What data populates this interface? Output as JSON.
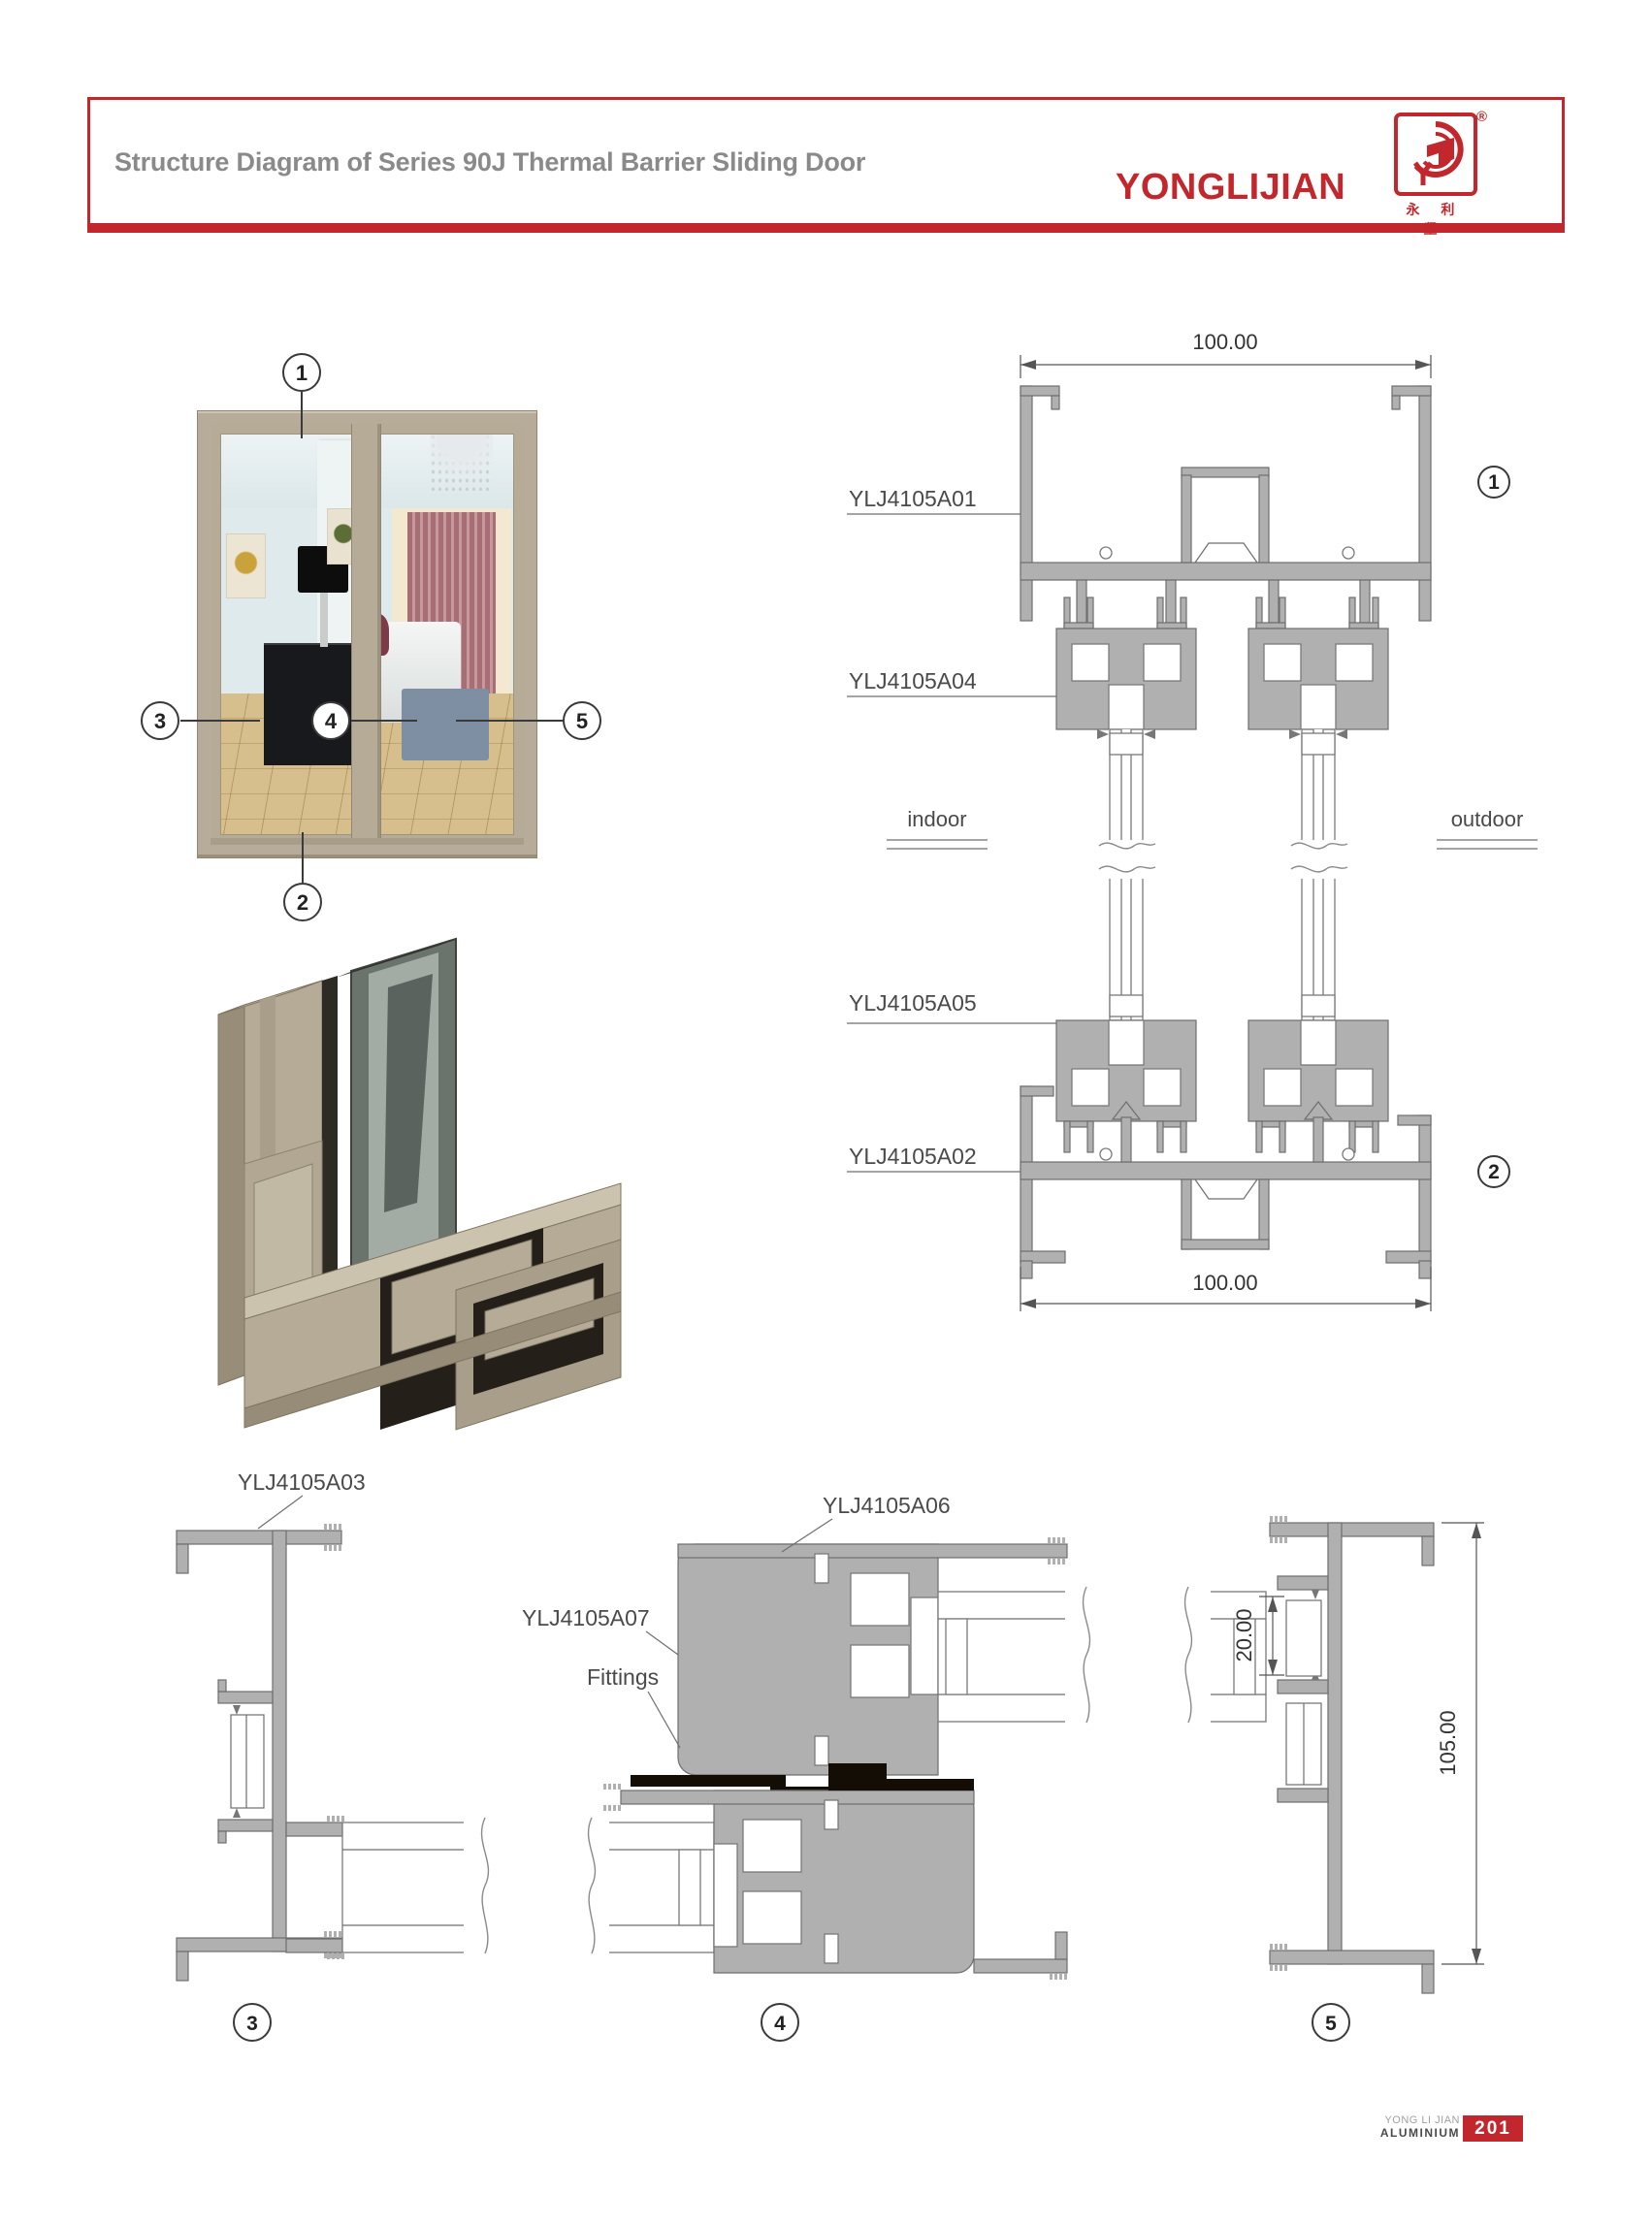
{
  "header": {
    "title": "Structure Diagram of Series 90J Thermal Barrier Sliding Door",
    "brand": "YONGLIJIAN",
    "brand_chinese": "永 利 坚",
    "registered_mark": "®"
  },
  "door": {
    "callouts": {
      "c1": "1",
      "c2": "2",
      "c3": "3",
      "c4": "4",
      "c5": "5"
    }
  },
  "vertical_section": {
    "dim_top": "100.00",
    "dim_bottom": "100.00",
    "label_a01": "YLJ4105A01",
    "label_a04": "YLJ4105A04",
    "label_a05": "YLJ4105A05",
    "label_a02": "YLJ4105A02",
    "indoor_label": "indoor",
    "outdoor_label": "outdoor",
    "callout_1": "1",
    "callout_2": "2"
  },
  "horizontal_section": {
    "label_a03": "YLJ4105A03",
    "label_a06": "YLJ4105A06",
    "label_a07": "YLJ4105A07",
    "fittings_label": "Fittings",
    "dim_pocket": "20.00",
    "dim_overall": "105.00",
    "callout_3": "3",
    "callout_4": "4",
    "callout_5": "5"
  },
  "footer": {
    "brand_line1": "YONG LI JIAN",
    "brand_line2": "ALUMINIUM",
    "page_number": "201"
  },
  "colors": {
    "accent_red": "#c1272d",
    "title_gray": "#8a8a8a",
    "profile_gray": "#b0b0b0",
    "frame_tan": "#b7ac99"
  }
}
